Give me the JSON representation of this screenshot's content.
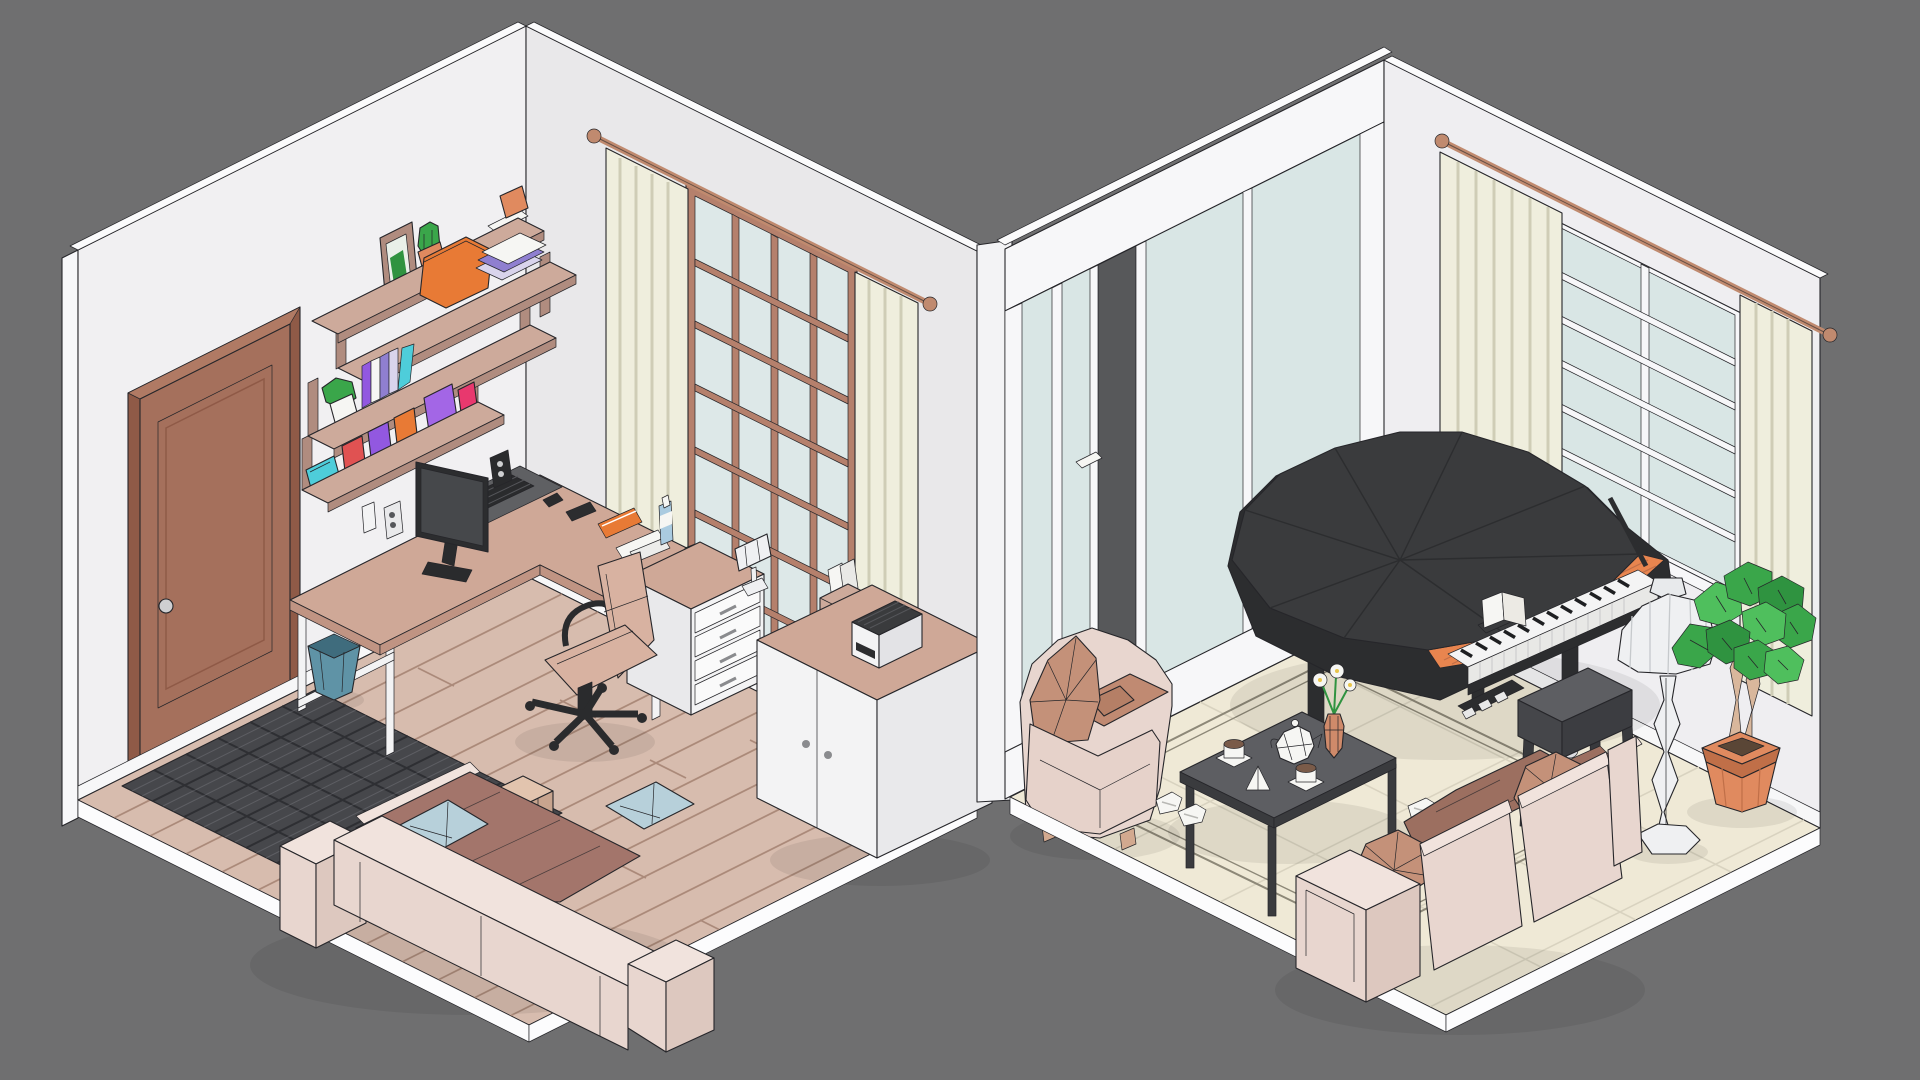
{
  "meta": {
    "image_type": "low-poly isometric 3D render",
    "description": "Cutaway isometric render of two adjoining rooms: a home office with desk, wall shelves, door, window, rug and sofa on the left; a living room with grand piano, coffee table with tea set, armchair, sofa, floor lamp and potted plant on the right."
  },
  "palette": {
    "background": "#6f6f70",
    "ink": "#26262a",
    "wall_left": "#f1f0f2",
    "wall_back": "#e9e8ea",
    "wall_right": "#efeef1",
    "wall_top": "#fbfbfc",
    "wall_outer": "#f7f7f9",
    "divider": "#f3f3f5",
    "floor_wood": "#d7bcae",
    "floor_wood_lt": "#e0c9bb",
    "floor_wood_line": "#ab8a7a",
    "floor_cream": "#efe9d6",
    "floor_cream_line": "#d9d3c0",
    "rug_border_line": "#8d8878",
    "baseboard": "#f7f7f8",
    "platform": "#fcfcfd",
    "door_brown": "#a5705c",
    "door_dark": "#8f5a47",
    "door_hi": "#b07a64",
    "knob": "#cfcfd1",
    "win_frame_brown": "#b5806c",
    "glass": "#dde8e8",
    "glass_right": "#d9e6e5",
    "glass_gap": "#57585a",
    "curtain": "#efeedd",
    "curtain_fold": "#cfcdb6",
    "rod_copper": "#c08a6f",
    "shelf_wood": "#cdaa9b",
    "shelf_wood_dark": "#b08c7f",
    "rug_dark": "#46474b",
    "rug_line": "#2e2f33",
    "rug_weave": "#9a9aa0",
    "sofa_shell": "#e8d6cf",
    "sofa_shell_lt": "#f1e3dd",
    "sofa_shell_side": "#ddc8bf",
    "blanket": "#a3756b",
    "pillow_blue": "#b7d0da",
    "pillow_brown": "#c49179",
    "seat_brown": "#c08a72",
    "chair_tan": "#d8b2a1",
    "black_part": "#2a2b2d",
    "desk_wood": "#cfa897",
    "desk_wood_dk": "#c09483",
    "unit_white": "#f3f3f4",
    "unit_gray": "#e9e9eb",
    "mat_gray": "#5f6063",
    "screen_gray": "#46484b",
    "piano_dark": "#3a3b3d",
    "piano_darker": "#2c2d2f",
    "piano_orange": "#e8854f",
    "keys_white": "#f4f4f4",
    "table_gray": "#5d5e62",
    "table_dark": "#3a3b3e",
    "lamp_white": "#eff0f2",
    "plant_green": "#3aa64a",
    "plant_green_lt": "#4fbf5d",
    "plant_green_dk": "#2f9340",
    "pot_terra": "#e08a5f",
    "pot_terra_dk": "#c06f48",
    "trunk_tan": "#d9b79c",
    "bin_blue": "#5f93a6",
    "bin_blue_dk": "#3f6c7d",
    "white": "#f6f6f3",
    "accent_orange": "#e87a35",
    "accent_red": "#e05252",
    "accent_purple": "#9258e0",
    "accent_violet": "#a366e6",
    "accent_pink": "#e8386e",
    "accent_cyan": "#4ecdda",
    "book_purple": "#8f7fd0",
    "book_light": "#d9d4ec",
    "tea_brown": "#7a5b49",
    "flower_yellow": "#e8c44a"
  },
  "scene": {
    "left_room": {
      "label": "home office",
      "objects": [
        "wooden panel door with knob",
        "staggered wall shelves with books, plants, jars and boxes",
        "gridded window with cream curtains and copper rod",
        "L-shaped desk with monitor, keyboard, speakers and desk mat",
        "white drawer unit with desk lamp",
        "white two-door cabinet with printer and file box",
        "office swivel chair",
        "dark woven tile rug",
        "wood plank floor",
        "blue waste bin",
        "sofa with brown blanket and blue pillows",
        "fabric pouf"
      ]
    },
    "right_room": {
      "label": "living room",
      "objects": [
        "glass sliding-door wall with one open panel",
        "white gridded window with cream curtains and copper rod",
        "black grand piano with open lid, sheet music and pedals",
        "piano bench",
        "dark coffee table with teapot, cups, napkin and flower vase",
        "upholstered armchair with faceted pillow",
        "three-seat sofa with blanket and pillows",
        "faceted white floor lamp",
        "green potted tree in terracotta pot",
        "two pairs of slippers",
        "cream tiled floor with area rug border"
      ]
    }
  }
}
